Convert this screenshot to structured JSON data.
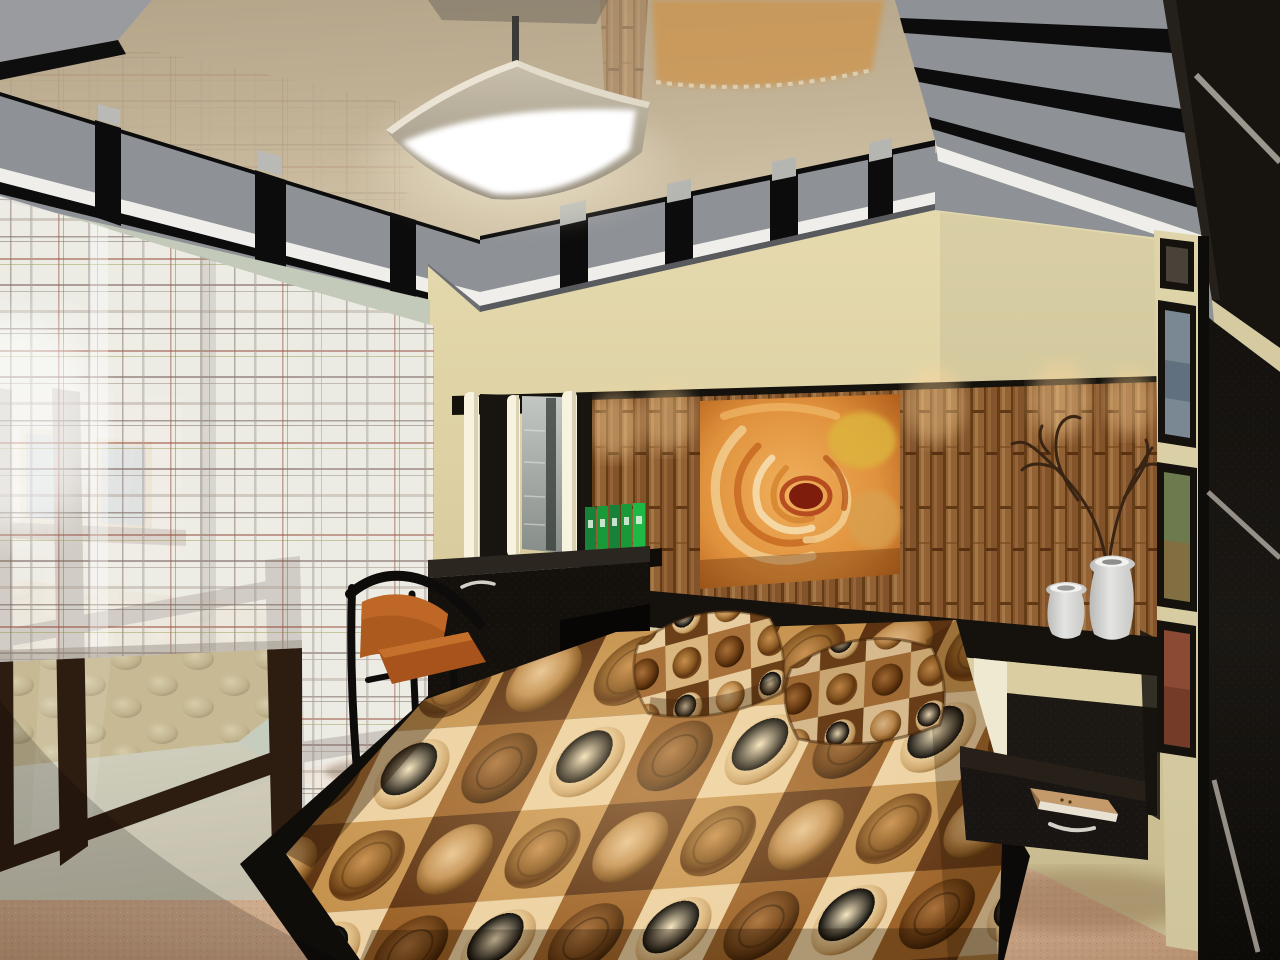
{
  "meta": {
    "type": "3d-interior-render",
    "room": "bedroom",
    "description": "Photorealistic 3D render of a modern bedroom: glossy stretch ceiling with gray floating panels, square ceiling lamp, sheer plaid curtains over a glass partition, black dressing table with mirror and light columns, bamboo accent niche with orange rose artwork, white vases with a dry branch, black platform bed with brown circle-pattern bedspread and two matching pillows, floating black nightstand with a book, cream pillar with framed pictures and a dark wardrobe with silver diagonal accents, beige carpet."
  },
  "palette": {
    "ceiling-gloss-1": "#b4a489",
    "ceiling-gloss-2": "#d2c4a8",
    "panel-gray": "#8e9196",
    "panel-gap": "#0c0c0c",
    "cove-white": "#efeeea",
    "soffit-gray": "#595a5e",
    "wall-cream": "#ddd1a3",
    "wall-shadow": "#c4b78c",
    "bamboo-mid": "#a8713c",
    "bamboo-dark": "#6e4318",
    "bamboo-light": "#cfa06a",
    "niche-black": "#15120d",
    "ledge-cream": "#d9cda1",
    "headboard-black": "#1c1813",
    "spread-dark": "#5e3312",
    "spread-mid": "#9c6228",
    "spread-tan": "#c6934f",
    "spread-cream": "#ecd2a4",
    "circle-brown": "#7a4515",
    "carpet-light": "#dfc7a6",
    "carpet-dark": "#a9815f",
    "glass-tint": "#ccd1c2",
    "wenge": "#2d1c10",
    "curtain-white": "#f5f3ee",
    "chair-orange": "#ad5a1f",
    "chair-frame": "#0e0c0a",
    "binder-green": "#199a38",
    "vase-white": "#e4e4e2",
    "branch-brown": "#3a2414",
    "book-tan": "#c59a6b",
    "lamp-white": "#ffffff",
    "shade-beige": "#c9c0ac",
    "art-orange": "#e0913c",
    "art-deep": "#b05c1a",
    "art-yellow": "#ddb43c",
    "pillar-cream": "#e0d5aa",
    "frame-black": "#15120e",
    "wardrobe-black": "#1b1814",
    "stripe-silver": "#aaa49c",
    "desk-black": "#14110d",
    "handle-silver": "#d3d0c8",
    "bench-quilt": "#d6c49a",
    "tile-floor": "#d6d2bf"
  },
  "scene": {
    "objects": [
      {
        "name": "stretch-ceiling",
        "finish": "gloss",
        "color": "#c8b99d"
      },
      {
        "name": "ceiling-panel-border",
        "color": "#8e9196"
      },
      {
        "name": "square-ceiling-lamp",
        "state": "on",
        "color": "#ffffff"
      },
      {
        "name": "sheer-plaid-curtains",
        "color": "#f5f3ee"
      },
      {
        "name": "glass-partition",
        "frame-color": "#2d1c10"
      },
      {
        "name": "quilted-bench-through-glass",
        "color": "#d6c49a"
      },
      {
        "name": "dressing-table",
        "color": "#14110d",
        "handles": 2
      },
      {
        "name": "mirror-with-light-columns",
        "light-columns": 3
      },
      {
        "name": "green-binders",
        "count": 5,
        "color": "#199a38"
      },
      {
        "name": "bamboo-accent-niche",
        "color": "#a8713c"
      },
      {
        "name": "rose-artwork",
        "color": "#e0913c"
      },
      {
        "name": "white-vases",
        "count": 2,
        "color": "#e4e4e2"
      },
      {
        "name": "dry-branch",
        "color": "#3a2414"
      },
      {
        "name": "platform-bed",
        "base-color": "#0f0d0a"
      },
      {
        "name": "circle-pattern-bedspread",
        "colors": [
          "#5e3312",
          "#9c6228",
          "#c6934f",
          "#ecd2a4"
        ]
      },
      {
        "name": "pattern-pillows",
        "count": 2
      },
      {
        "name": "chair",
        "seat-color": "#ad5a1f",
        "frame-color": "#0e0c0a"
      },
      {
        "name": "floating-nightstand",
        "color": "#191512"
      },
      {
        "name": "book-on-nightstand",
        "color": "#c59a6b"
      },
      {
        "name": "picture-frames-right",
        "count": 4,
        "frame-color": "#15120e"
      },
      {
        "name": "wardrobe",
        "color": "#1b1814",
        "accent": "#aaa49c"
      },
      {
        "name": "carpet",
        "color": "#cfa988"
      }
    ]
  }
}
